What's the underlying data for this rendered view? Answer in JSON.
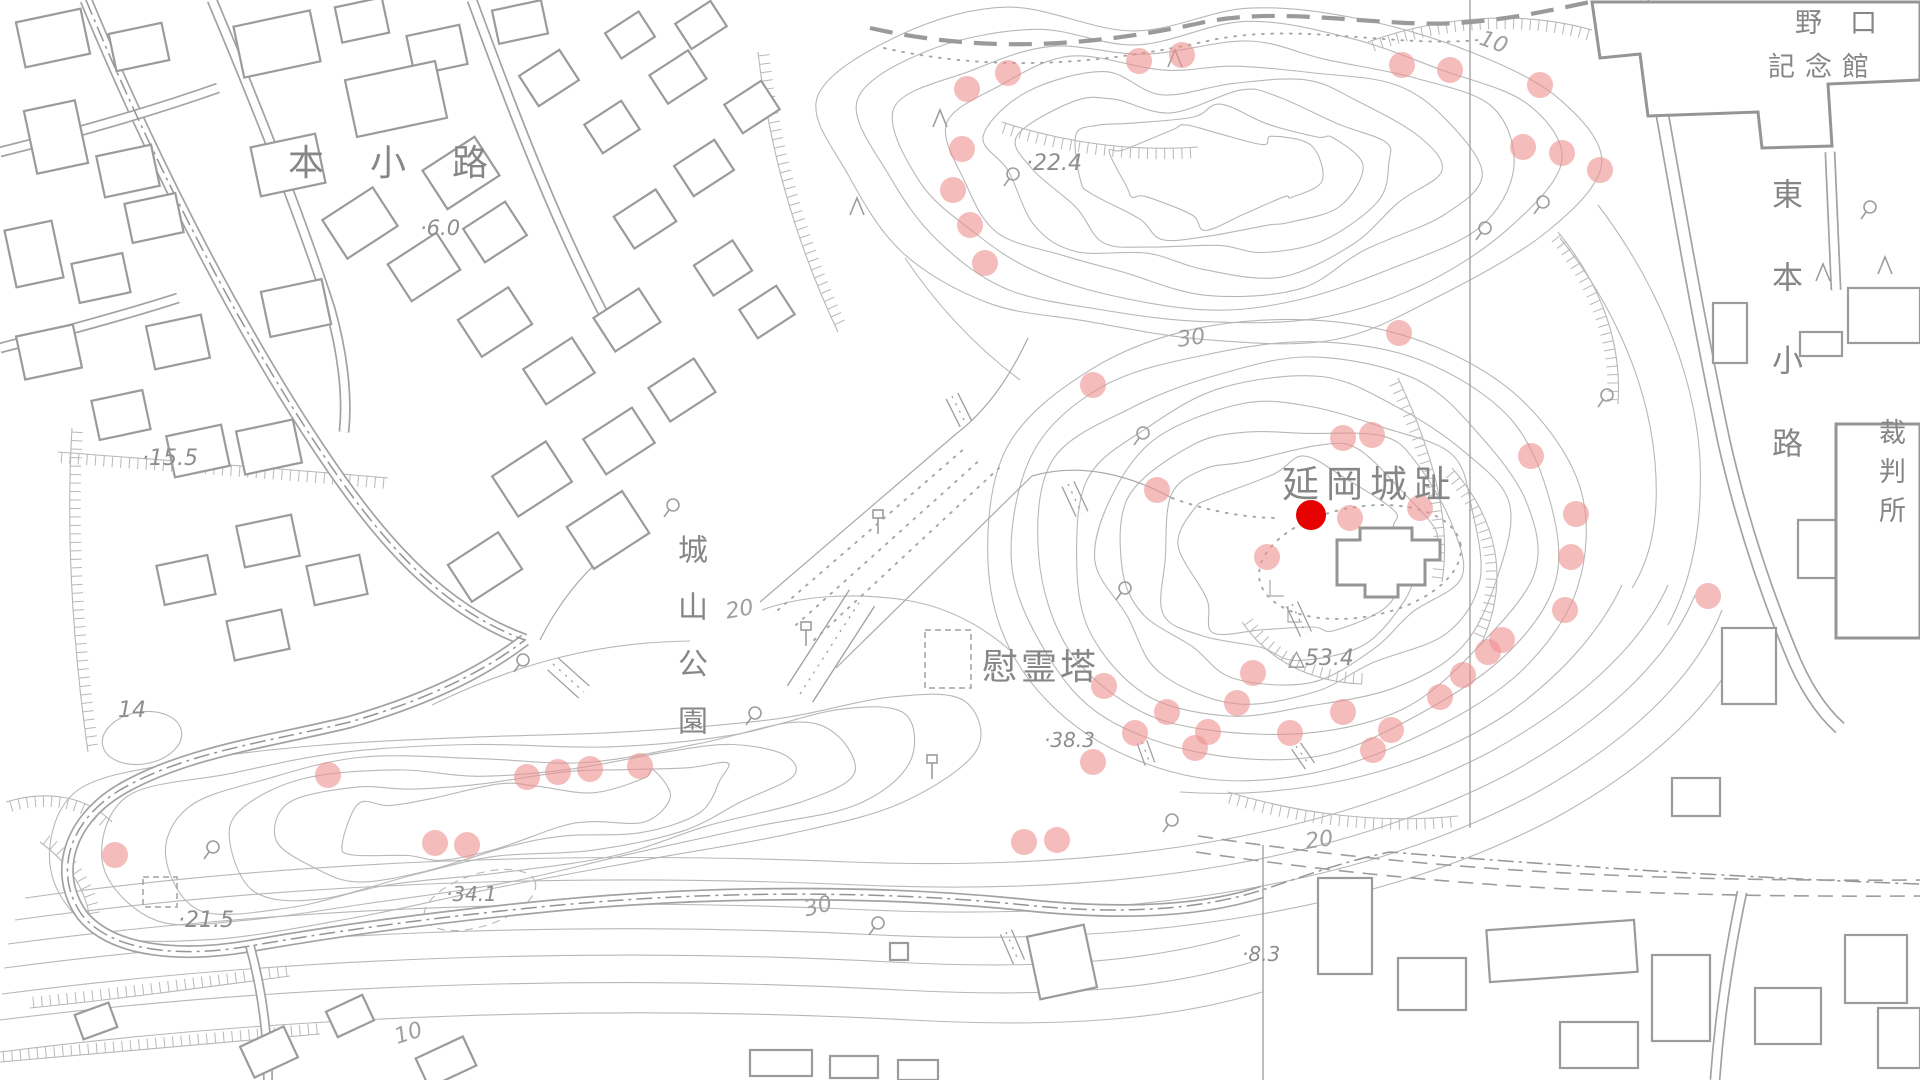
{
  "map": {
    "place_labels": [
      {
        "id": "hon-koji",
        "text": "本小路",
        "x": 288,
        "y": 146,
        "size": 36,
        "spacing": 46,
        "vertical": false
      },
      {
        "id": "noguchi-line1",
        "text": "野口",
        "x": 1795,
        "y": 10,
        "size": 27,
        "spacing": 28,
        "vertical": false
      },
      {
        "id": "noguchi-line2",
        "text": "記念館",
        "x": 1768,
        "y": 54,
        "size": 27,
        "spacing": 10,
        "vertical": false
      },
      {
        "id": "higashi-hon-koji",
        "text": "東本小路",
        "x": 1768,
        "y": 178,
        "size": 31,
        "spacing": 52,
        "vertical": true
      },
      {
        "id": "saibansho",
        "text": "裁判所",
        "x": 1876,
        "y": 418,
        "size": 27,
        "spacing": 12,
        "vertical": true
      },
      {
        "id": "shiroyama-koen",
        "text": "城山公園",
        "x": 674,
        "y": 534,
        "size": 30,
        "spacing": 27,
        "vertical": true
      },
      {
        "id": "nobeoka-joshi",
        "text": "延岡城趾",
        "x": 1282,
        "y": 466,
        "size": 37,
        "spacing": 7,
        "vertical": false
      },
      {
        "id": "ireito",
        "text": "慰霊塔",
        "x": 982,
        "y": 650,
        "size": 36,
        "spacing": 3,
        "vertical": false
      }
    ],
    "spot_elevations": [
      {
        "text": "·6.0",
        "x": 420,
        "y": 218,
        "size": 21
      },
      {
        "text": "·15.5",
        "x": 142,
        "y": 448,
        "size": 22
      },
      {
        "text": "14",
        "x": 118,
        "y": 700,
        "size": 22
      },
      {
        "text": "·21.5",
        "x": 178,
        "y": 910,
        "size": 22
      },
      {
        "text": "·34.1",
        "x": 446,
        "y": 884,
        "size": 20
      },
      {
        "text": "·22.4",
        "x": 1026,
        "y": 153,
        "size": 22
      },
      {
        "text": "·38.3",
        "x": 1044,
        "y": 730,
        "size": 20
      },
      {
        "text": "·8.3",
        "x": 1242,
        "y": 944,
        "size": 20
      },
      {
        "text": "△53.4",
        "x": 1288,
        "y": 648,
        "size": 22
      }
    ],
    "contour_labels": [
      {
        "text": "10",
        "x": 1484,
        "y": 28,
        "rot": 20,
        "size": 22
      },
      {
        "text": "30",
        "x": 1176,
        "y": 330,
        "rot": -8,
        "size": 22
      },
      {
        "text": "20",
        "x": 724,
        "y": 602,
        "rot": -10,
        "size": 22
      },
      {
        "text": "30",
        "x": 802,
        "y": 900,
        "rot": -14,
        "size": 22
      },
      {
        "text": "20",
        "x": 1304,
        "y": 832,
        "rot": -8,
        "size": 22
      },
      {
        "text": "10",
        "x": 392,
        "y": 1028,
        "rot": -18,
        "size": 22
      }
    ],
    "annotation": {
      "pink_dot_radius": 13,
      "pink_dot_color": "#ef8f8f",
      "pink_dot_opacity": 0.6,
      "pink_dots": [
        [
          967,
          89
        ],
        [
          1008,
          73
        ],
        [
          1139,
          61
        ],
        [
          1182,
          55
        ],
        [
          1402,
          65
        ],
        [
          1450,
          70
        ],
        [
          1540,
          85
        ],
        [
          1523,
          147
        ],
        [
          1562,
          153
        ],
        [
          1600,
          170
        ],
        [
          962,
          149
        ],
        [
          953,
          190
        ],
        [
          970,
          225
        ],
        [
          985,
          263
        ],
        [
          1093,
          385
        ],
        [
          1157,
          490
        ],
        [
          1343,
          438
        ],
        [
          1372,
          435
        ],
        [
          1399,
          333
        ],
        [
          1350,
          518
        ],
        [
          1420,
          508
        ],
        [
          1267,
          557
        ],
        [
          1531,
          456
        ],
        [
          1576,
          514
        ],
        [
          1571,
          557
        ],
        [
          1565,
          610
        ],
        [
          1104,
          686
        ],
        [
          1135,
          733
        ],
        [
          1093,
          762
        ],
        [
          1167,
          712
        ],
        [
          1195,
          748
        ],
        [
          1208,
          732
        ],
        [
          1237,
          703
        ],
        [
          1253,
          673
        ],
        [
          1290,
          733
        ],
        [
          1343,
          712
        ],
        [
          1373,
          750
        ],
        [
          1391,
          730
        ],
        [
          1440,
          697
        ],
        [
          1463,
          675
        ],
        [
          1488,
          652
        ],
        [
          1502,
          640
        ],
        [
          1708,
          596
        ],
        [
          1024,
          842
        ],
        [
          1057,
          840
        ],
        [
          115,
          855
        ],
        [
          328,
          775
        ],
        [
          435,
          843
        ],
        [
          467,
          845
        ],
        [
          527,
          777
        ],
        [
          558,
          772
        ],
        [
          590,
          769
        ],
        [
          640,
          766
        ]
      ],
      "marker": {
        "x": 1311,
        "y": 515,
        "r": 15,
        "color": "#e60000"
      }
    },
    "colors": {
      "background": "#ffffff",
      "linework": "#b7b7b7",
      "roads": "#a2a2a2",
      "buildings": "#9b9b9b",
      "text": "#868686"
    }
  }
}
